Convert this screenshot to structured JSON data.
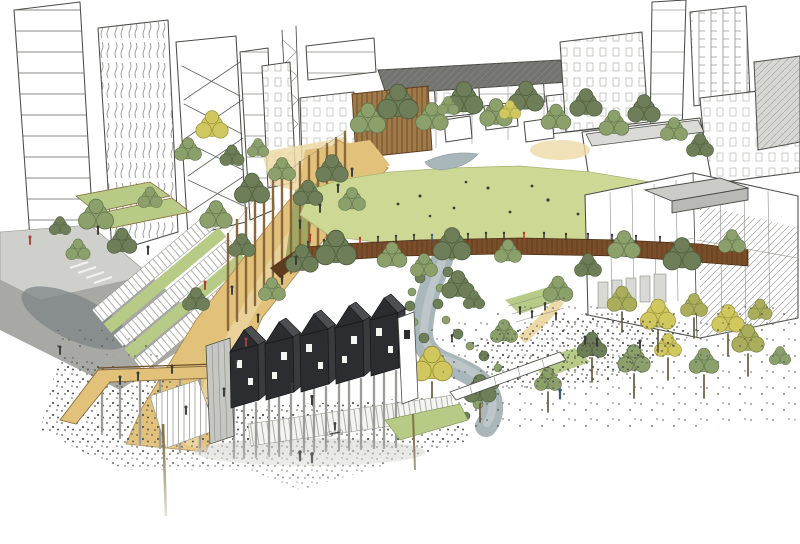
{
  "image": {
    "type": "hand-drawn architectural concept sketch, aerial perspective, pen and watercolour wash",
    "title": "Artist's impression - urban park and waterway masterplan",
    "description": "Sketched white tower blocks and stepped mid-rise buildings frame a new city park. A pale green lawn sits at the centre ringed by green and olive trees. A rust-coloured slatted elevated walkway with tiny figures crosses the park. A timber promenade with a tall pergola colonnade and terraced steps descends to the lower left past a grey street. A grey-blue stream winds from the park down through planted banks. In the foreground a black gabled pavilion of five modules stands on slender stilts above shallow steps, with an ochre access ramp at left, a low white wall at right, scattered trees and stippled gravel ground fading to white at the edges."
  },
  "scene": {
    "background": [
      "left-tower-blocks",
      "lattice-mast",
      "centre-station-buildings",
      "dark-roof-canopy",
      "bronze-slatted-building",
      "terrace-houses",
      "right-stepped-buildings"
    ],
    "midground": [
      "street-and-crossing",
      "terraced-steps-and-planting",
      "timber-promenade",
      "pergola-colonnade",
      "central-lawn",
      "park-tree-belt",
      "upper-pond",
      "rust-elevated-walkway",
      "white-office-building",
      "winding-stream"
    ],
    "foreground": [
      "timber-access-ramp",
      "stair-flight",
      "black-stilt-pavilion",
      "concrete-stair-core",
      "shallow-steps",
      "low-white-wall",
      "gravel-plaza",
      "scattered-trees",
      "pedestrian-figures",
      "timber-pole"
    ]
  },
  "palette": {
    "paper": "#ffffff",
    "ink": "#4b4b47",
    "hatch": "#8d8d88",
    "lawn": "#ccd893",
    "grass": "#b7cb87",
    "tree-dark": "#6e7e58",
    "tree-mid": "#8ca06c",
    "tree-olive": "#a9ad5c",
    "tree-yellow": "#d0c75e",
    "path-tan": "#dcba72",
    "path-light": "#ecd9a6",
    "boardwalk": "#e2c17b",
    "post-brown": "#8a683c",
    "bridge-rust": "#7a4e2a",
    "water": "#a9b6ba",
    "road-gray": "#a8a8a4",
    "road-dark": "#7e8486",
    "concrete": "#cbcbc7",
    "pavilion-dark": "#2c2d30",
    "pavilion-roof": "#4c4e52",
    "stilt-gray": "#9b9b98",
    "stipple": "#55554f",
    "figure": "#3a3a36",
    "accent-red": "#b03a33",
    "accent-blue": "#3e5a77"
  }
}
